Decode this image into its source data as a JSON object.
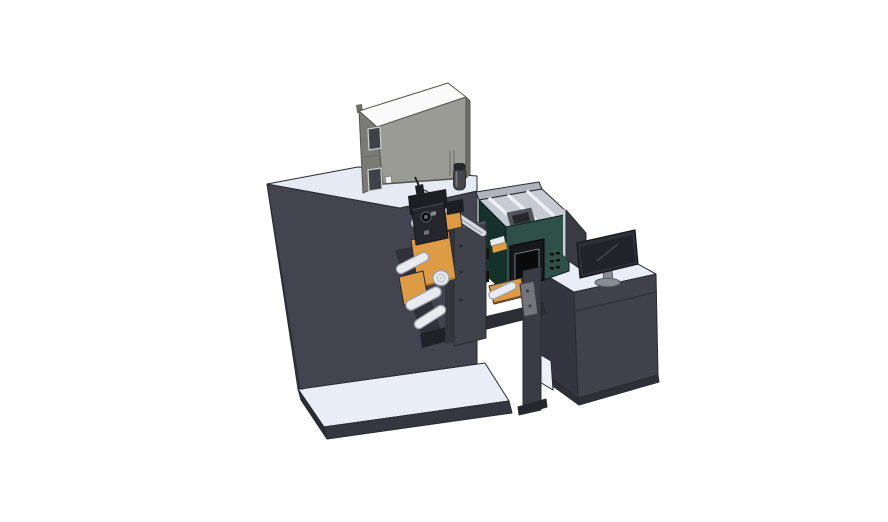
{
  "scene": {
    "background": "#ffffff",
    "render_style": "3d-cad-isometric",
    "subject": "roll-fed printing machine with operator desk"
  },
  "colors": {
    "outline": "#2a2b31",
    "platform_top": "#e9edf8",
    "platform_front": "#35363f",
    "platform_left": "#2b2c33",
    "cabinet_top": "#e6eaf5",
    "cabinet_front": "#434450",
    "cabinet_left": "#383944",
    "graybox_top": "#fafafa",
    "graybox_front": "#9b9b96",
    "graybox_left": "#7b7b76",
    "graybox_edge": "#6e6e68",
    "window_glass": "#40414a",
    "window_frame": "#cfcfca",
    "white_accent": "#f2f3f5",
    "cylinder_body": "#45464c",
    "cylinder_cap": "#26272b",
    "cylinder_highlight": "#787a80",
    "teal_front": "#2e5049",
    "teal_side": "#16302b",
    "interior": "#c6cad2",
    "interior_wall": "#aeb3bd",
    "interior_bar": "#eef0f5",
    "interior_machinery": "#53545c",
    "interior_machinery_dark": "#26272c",
    "magenta": "#c45ed2",
    "display_frame": "#17181c",
    "display_screen": "#0a0a0c",
    "display_border": "#8d9097",
    "vent": "#101108",
    "desk_top": "#e9edf8",
    "desk_front": "#40414b",
    "desk_left": "#343540",
    "desk_base": "#2e2f37",
    "shelf_interior": "#eef1f9",
    "panel_body": "#3a3b42",
    "panel_edge": "#c9cdd6",
    "monitor_bezel": "#2e2f36",
    "monitor_screen": "#22232a",
    "monitor_reflection": "#42434b",
    "monitor_stand": "#878b94",
    "beam": "#2c2d35",
    "column": "#3a3b44",
    "column_foot": "#26272e",
    "bracket": "#73747c",
    "bracket_hole": "#3f4047",
    "orange": "#dd9b45",
    "orange_dark": "#b5782c",
    "orange_shadow": "#7a5320",
    "roller_fill": "#e9ebf1",
    "roller_stroke": "#9aa0aa",
    "roller_ring": "#b8bcc6",
    "roller_hub": "#c6cad2",
    "plate_front": "#3f414b",
    "plate_back": "#33343c",
    "plate_edge": "#585a64",
    "underplate": "#30313a",
    "under_bracket": "#202126",
    "mech_dark": "#1d1e22",
    "mech_mid": "#26272c",
    "mech_deep": "#0b0b0d",
    "mech_ring": "#53555e",
    "mech_hub": "#6a6c75",
    "mech_light": "#858893",
    "mech_light2": "#6f727c",
    "bolt": "#262730",
    "dot_dark": "#2b2c32",
    "guide_bar_fill": "#d5d8e0",
    "guide_bar_outline": "#40414a",
    "guide_bar_line": "#9194a0"
  }
}
